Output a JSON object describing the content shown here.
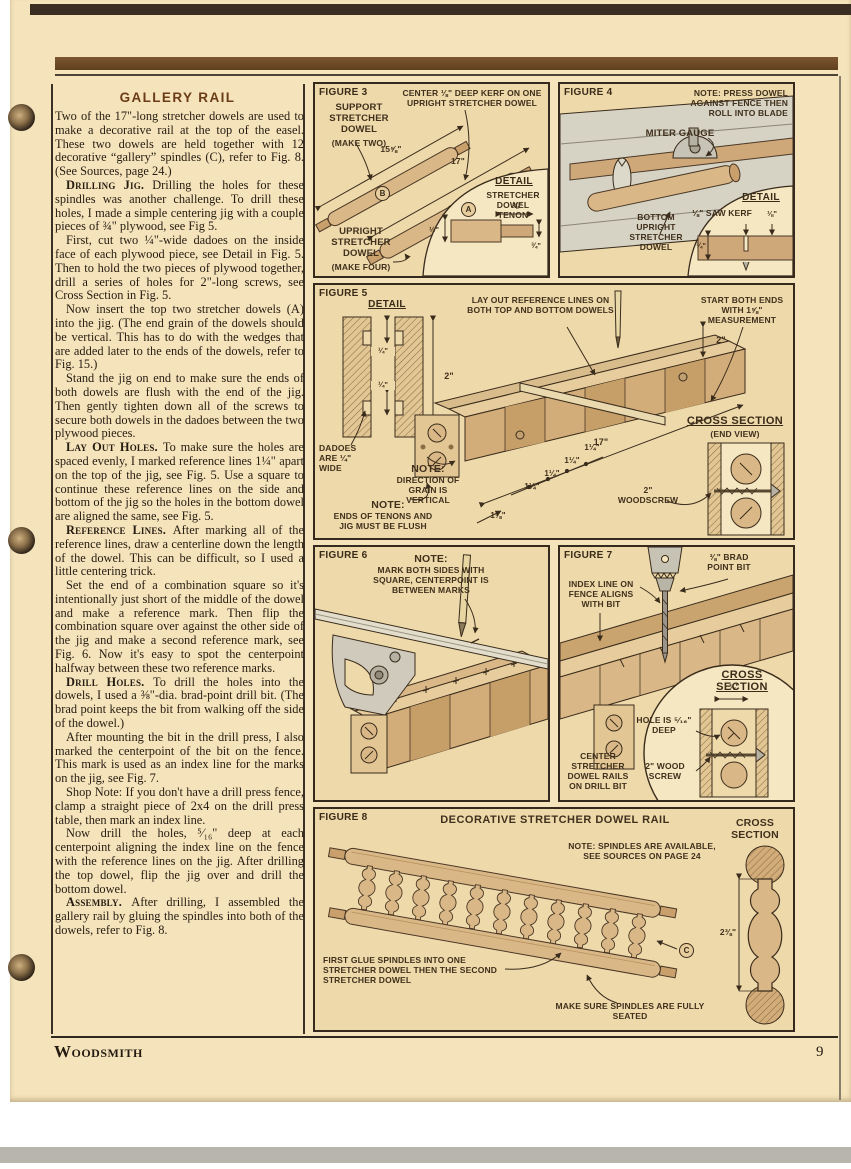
{
  "page": {
    "brand": "Woodsmith",
    "page_number": "9"
  },
  "article": {
    "title": "GALLERY RAIL",
    "paragraphs": [
      {
        "lead": "",
        "text": "Two of the 17\"-long stretcher dowels are used to make a decorative rail at the top of the easel. These two dowels are held together with 12 decorative “gallery” spindles (C), refer to Fig. 8. (See Sources, page 24.)"
      },
      {
        "lead": "Drilling Jig.",
        "text": "Drilling the holes for these spindles was another challenge. To drill these holes, I made a simple centering jig with a couple pieces of ¾\" plywood, see Fig 5."
      },
      {
        "lead": "",
        "text": "First, cut two ¼\"-wide dadoes on the inside face of each plywood piece, see Detail in Fig. 5. Then to hold the two pieces of plywood together, drill a series of holes for 2\"-long screws, see Cross Section in Fig. 5."
      },
      {
        "lead": "",
        "text": "Now insert the top two stretcher dowels (A) into the jig. (The end grain of the dowels should be vertical. This has to do with the wedges that are added later to the ends of the dowels, refer to Fig. 15.)"
      },
      {
        "lead": "",
        "text": "Stand the jig on end to make sure the ends of both dowels are flush with the end of the jig. Then gently tighten down all of the screws to secure both dowels in the dadoes between the two plywood pieces."
      },
      {
        "lead": "Lay Out Holes.",
        "text": "To make sure the holes are spaced evenly, I marked reference lines 1¼\" apart on the top of the jig, see Fig. 5. Use a square to continue these reference lines on the side and bottom of the jig so the holes in the bottom dowel are aligned the same, see Fig. 5."
      },
      {
        "lead": "Reference Lines.",
        "text": "After marking all of the reference lines, draw a centerline down the length of the dowel. This can be difficult, so I used a little centering trick."
      },
      {
        "lead": "",
        "text": "Set the end of a combination square so it's intentionally just short of the middle of the dowel and make a reference mark. Then flip the combination square over against the other side of the jig and make a second reference mark, see Fig. 6. Now it's easy to spot the centerpoint halfway between these two reference marks."
      },
      {
        "lead": "Drill Holes.",
        "text": "To drill the holes into the dowels, I used a ⅜\"-dia. brad-point drill bit. (The brad point keeps the bit from walking off the side of the dowel.)"
      },
      {
        "lead": "",
        "text": "After mounting the bit in the drill press, I also marked the centerpoint of the bit on the fence. This mark is used as an index line for the marks on the jig, see Fig. 7."
      },
      {
        "lead": "",
        "text": "Shop Note: If you don't have a drill press fence, clamp a straight piece of 2x4 on the drill press table, then mark an index line."
      },
      {
        "lead": "",
        "text": "Now drill the holes, ⁵⁄₁₆\" deep at each centerpoint aligning the index line on the fence with the reference lines on the jig. After drilling the top dowel, flip the jig over and drill the bottom dowel."
      },
      {
        "lead": "Assembly.",
        "text": "After drilling, I assembled the gallery rail by gluing the spindles into both of the dowels, refer to Fig. 8."
      }
    ]
  },
  "fig3": {
    "label": "FIGURE 3",
    "top_note": "CENTER ⅛\" DEEP KERF ON ONE UPRIGHT STRETCHER DOWEL",
    "support": "SUPPORT STRETCHER DOWEL",
    "support_sub": "(MAKE TWO)",
    "dim_len_b": "15⅝\"",
    "dim_len_a": "17\"",
    "letter_a": "A",
    "letter_b": "B",
    "upright": "UPRIGHT STRETCHER DOWEL",
    "upright_sub": "(MAKE FOUR)",
    "detail_title": "DETAIL",
    "detail_caption": "STRETCHER DOWEL TENON",
    "dim_78": "⅞\"",
    "dim_12": "½\"",
    "dim_34": "¾\""
  },
  "fig4": {
    "label": "FIGURE 4",
    "note": "NOTE: PRESS DOWEL AGAINST FENCE THEN ROLL INTO BLADE",
    "miter": "MITER GAUGE",
    "bottom": "BOTTOM UPRIGHT STRETCHER DOWEL",
    "detail_title": "DETAIL",
    "kerf": "⅛\" SAW KERF",
    "dim_18": "⅛\"",
    "dim_34": "¾\""
  },
  "fig5": {
    "label": "FIGURE 5",
    "detail_title": "DETAIL",
    "layout_note": "LAY OUT REFERENCE LINES ON BOTH TOP AND BOTTOM DOWELS",
    "start_note": "START BOTH ENDS WITH 1⅝\" MEASUREMENT",
    "dim_2_right": "2\"",
    "dim_14_top": "¼\"",
    "dim_14_bottom": "¼\"",
    "dim_2_detail": "2\"",
    "dadoes": "DADOES ARE ¼\" WIDE",
    "note1_lead": "NOTE:",
    "note1": "DIRECTION OF GRAIN IS VERTICAL",
    "note2_lead": "NOTE:",
    "note2": "ENDS OF TENONS AND JIG MUST BE FLUSH",
    "dim_17": "17\"",
    "dim_114_1": "1¼\"",
    "dim_114_2": "1¼\"",
    "dim_114_3": "1¼\"",
    "dim_114_4": "1¼\"",
    "dim_158": "1⅝\"",
    "cross_title": "CROSS SECTION",
    "cross_sub": "(END VIEW)",
    "screw": "2\" WOODSCREW"
  },
  "fig6": {
    "label": "FIGURE 6",
    "note_lead": "NOTE:",
    "note": "MARK BOTH SIDES WITH SQUARE, CENTERPOINT IS BETWEEN MARKS"
  },
  "fig7": {
    "label": "FIGURE 7",
    "bit": "⅜\" BRAD POINT BIT",
    "index": "INDEX LINE ON FENCE ALIGNS WITH BIT",
    "cross_title": "CROSS SECTION",
    "dim_38": "⅜\"",
    "hole": "HOLE IS ⁵⁄₁₆\" DEEP",
    "screw": "2\" WOOD SCREW",
    "center": "CENTER STRETCHER DOWEL RAILS ON DRILL BIT"
  },
  "fig8": {
    "label": "FIGURE 8",
    "title": "DECORATIVE STRETCHER DOWEL RAIL",
    "note": "NOTE: SPINDLES ARE AVAILABLE, SEE SOURCES ON PAGE 24",
    "glue": "FIRST GLUE SPINDLES INTO ONE STRETCHER DOWEL THEN THE SECOND STRETCHER DOWEL",
    "seated": "MAKE SURE SPINDLES ARE FULLY SEATED",
    "letter_c": "C",
    "cross_title": "CROSS SECTION",
    "dim": "2⅜\""
  }
}
